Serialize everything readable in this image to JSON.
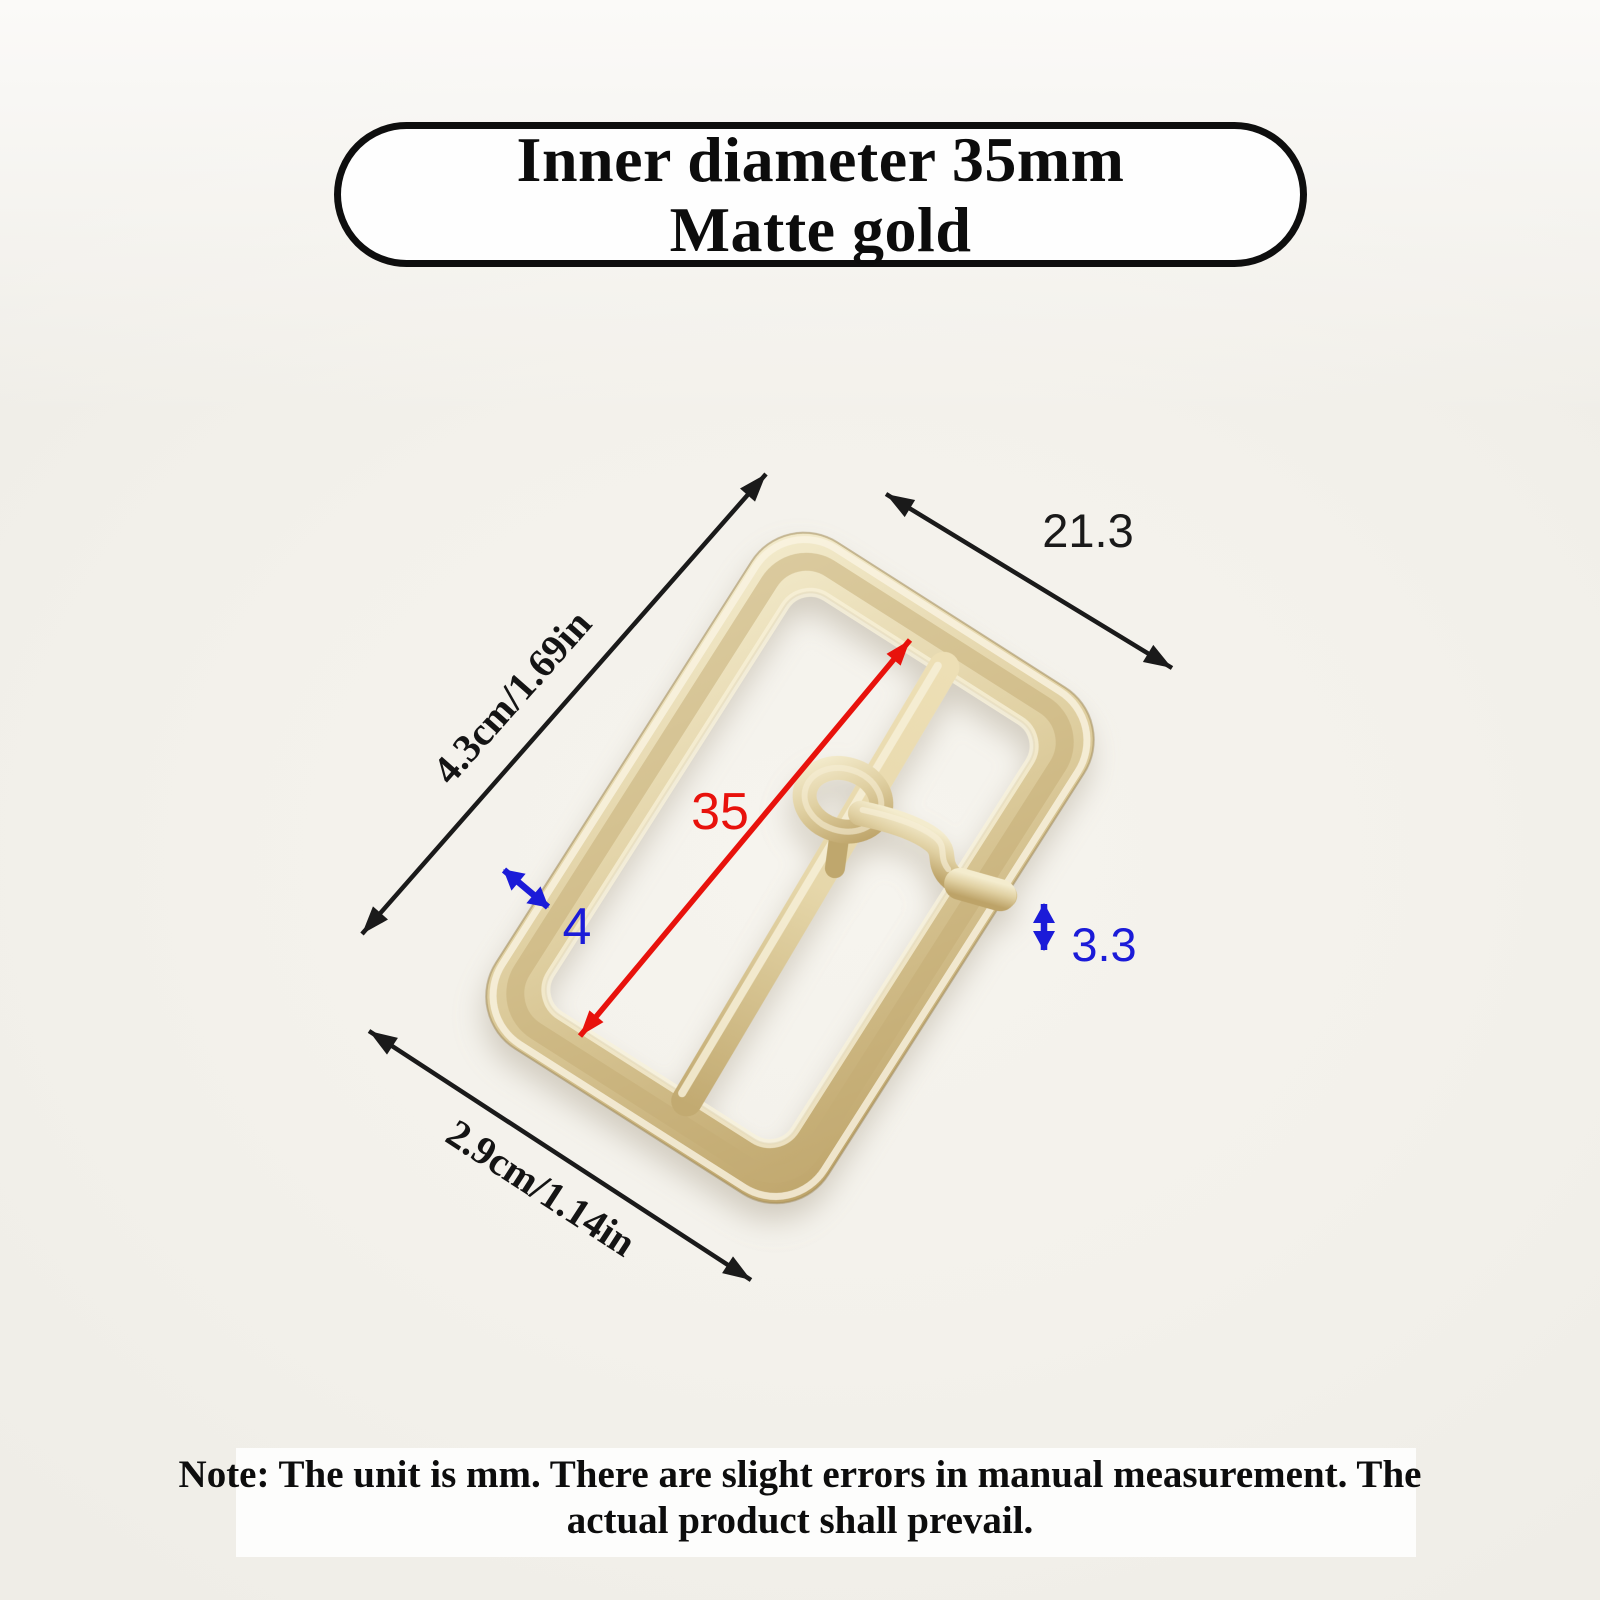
{
  "badge": {
    "line1": "Inner diameter 35mm",
    "line2": "Matte gold"
  },
  "dimensions": {
    "top_width": "21.3",
    "side_length": "4.3cm/1.69in",
    "bottom_width": "2.9cm/1.14in",
    "inner_diameter": "35",
    "frame_thickness": "4",
    "pin_thickness": "3.3"
  },
  "note": {
    "line1": "Note: The unit is mm. There are slight errors in manual measurement. The",
    "line2": "actual product shall prevail."
  },
  "product": {
    "item": "belt-buckle",
    "finish": "matte gold"
  },
  "colors": {
    "background": "#f3f1eb",
    "band": "#fdfdfc",
    "badge_border": "#0e0e0e",
    "gold_light": "#f6eed2",
    "gold_mid": "#ddcc9c",
    "gold_dark": "#bda368",
    "dim_black": "#1a1a1a",
    "dim_red": "#e8120c",
    "dim_blue": "#1b1bd8"
  }
}
